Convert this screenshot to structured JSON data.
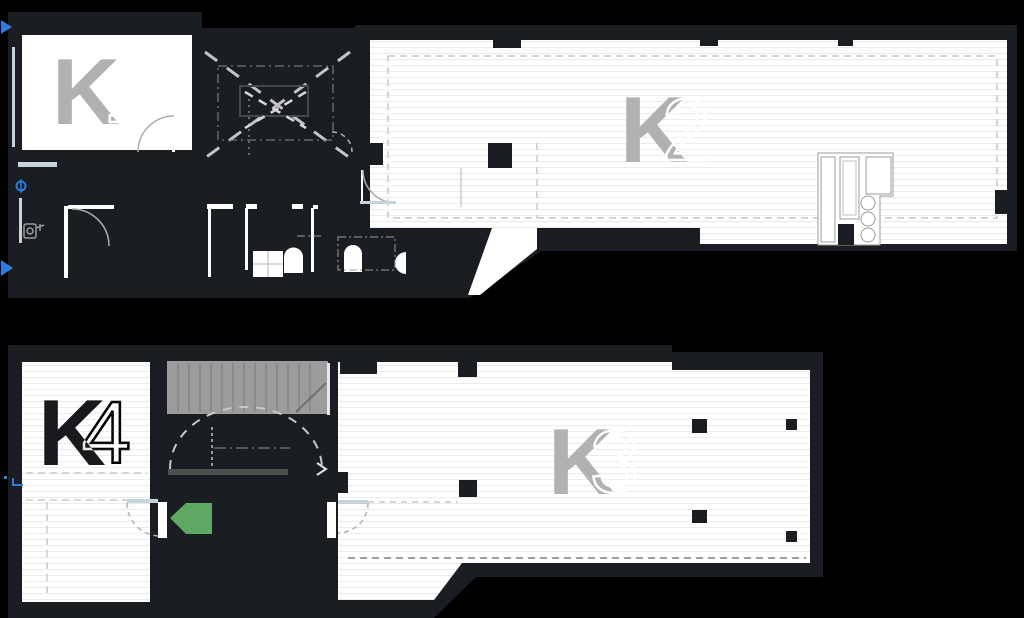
{
  "title": "Building floor plan with units K1-K4",
  "colors": {
    "background": "#000000",
    "wall": "#1a1d21",
    "floor": "#ffffff",
    "plank": "#ebebeb",
    "stair": "#9c9c9c",
    "label_gray": "#b1b1b1",
    "label_dark": "#17191c",
    "accent_green": "#5ea863",
    "accent_blue": "#2e7ce0",
    "glazing": "#c6d3db",
    "dash_gray": "#c9c9c9"
  },
  "units": {
    "k1": {
      "letter": "K",
      "number": "1"
    },
    "k2": {
      "letter": "K",
      "number": "2"
    },
    "k3": {
      "letter": "K",
      "number": "3"
    },
    "k4": {
      "letter": "K",
      "number": "4"
    }
  }
}
